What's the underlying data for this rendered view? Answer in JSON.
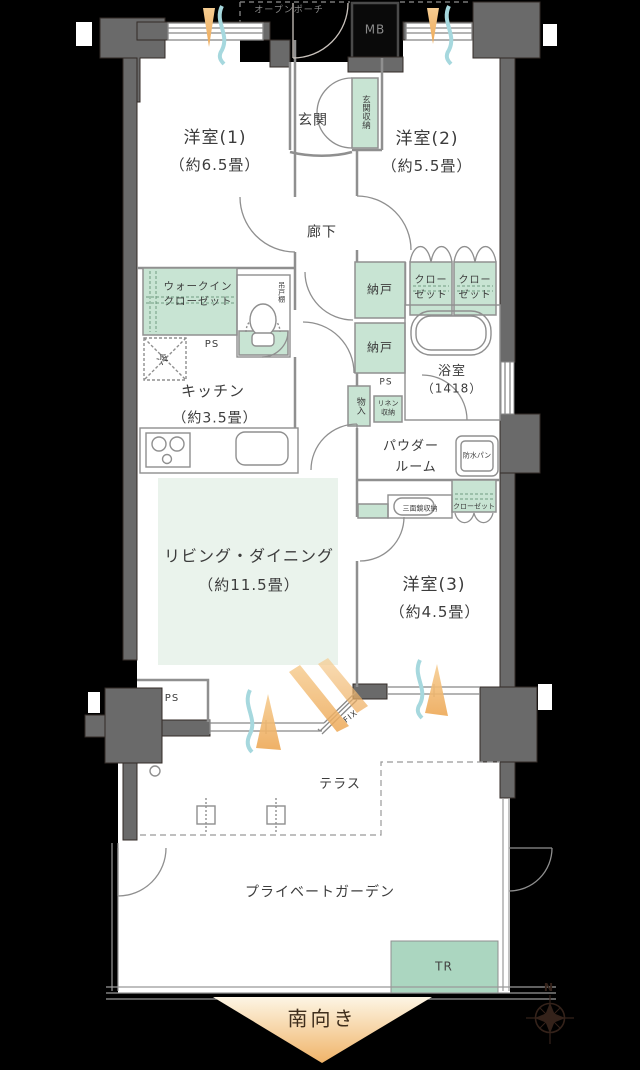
{
  "colors": {
    "background": "#000000",
    "wall": "#6a6a6a",
    "storage_green": "#c8e4d3",
    "living_tint": "#eaf3ec",
    "trunk_green": "#abd6c0",
    "line": "#8f8f8f",
    "text": "#3c3c3c",
    "south_arrow": "#f2bd79",
    "airflow_orange": "#f3c083",
    "airflow_blue": "#a6d8de",
    "compass": "#34221a"
  },
  "rooms": {
    "bedroom1": {
      "name": "洋室(1)",
      "size": "（約6.5畳）"
    },
    "bedroom2": {
      "name": "洋室(2)",
      "size": "（約5.5畳）"
    },
    "bedroom3": {
      "name": "洋室(3)",
      "size": "（約4.5畳）"
    },
    "living_dining": {
      "name": "リビング・ダイニング",
      "size": "（約11.5畳）"
    },
    "kitchen": {
      "name": "キッチン",
      "size": "（約3.5畳）"
    },
    "entrance": {
      "name": "玄関"
    },
    "hallway": {
      "name": "廊下"
    },
    "bathroom": {
      "name": "浴室",
      "size": "（1418）"
    },
    "powder_room": {
      "line1": "パウダー",
      "line2": "ルーム"
    },
    "terrace": {
      "name": "テラス"
    },
    "private_garden": {
      "name": "プライベートガーデン"
    }
  },
  "storage": {
    "entrance_storage": "玄関収納",
    "walk_in_closet": {
      "line1": "ウォークイン",
      "line2": "クローゼット"
    },
    "hanging_cupboard": "吊戸棚",
    "storeroom_upper": "納戸",
    "storeroom_lower": "納戸",
    "closet_left": {
      "line1": "クロー",
      "line2": "ゼット"
    },
    "closet_right": {
      "line1": "クロー",
      "line2": "ゼット"
    },
    "small_storage": "物入",
    "linen": {
      "line1": "リネン",
      "line2": "収納"
    },
    "mirror_cabinet": "三面鏡収納",
    "bedroom3_closet": "クローゼット"
  },
  "labels": {
    "open_porch": "オープンポーチ",
    "meter_box": "MB",
    "ps_wic": "PS",
    "ps_linen": "PS",
    "ps_bottom": "PS",
    "refrigerator": "冷",
    "waterproof_pan": "防水パン",
    "fix_window": "FIX",
    "trunk_room": "TR",
    "south_facing": "南向き",
    "compass_north": "N"
  }
}
